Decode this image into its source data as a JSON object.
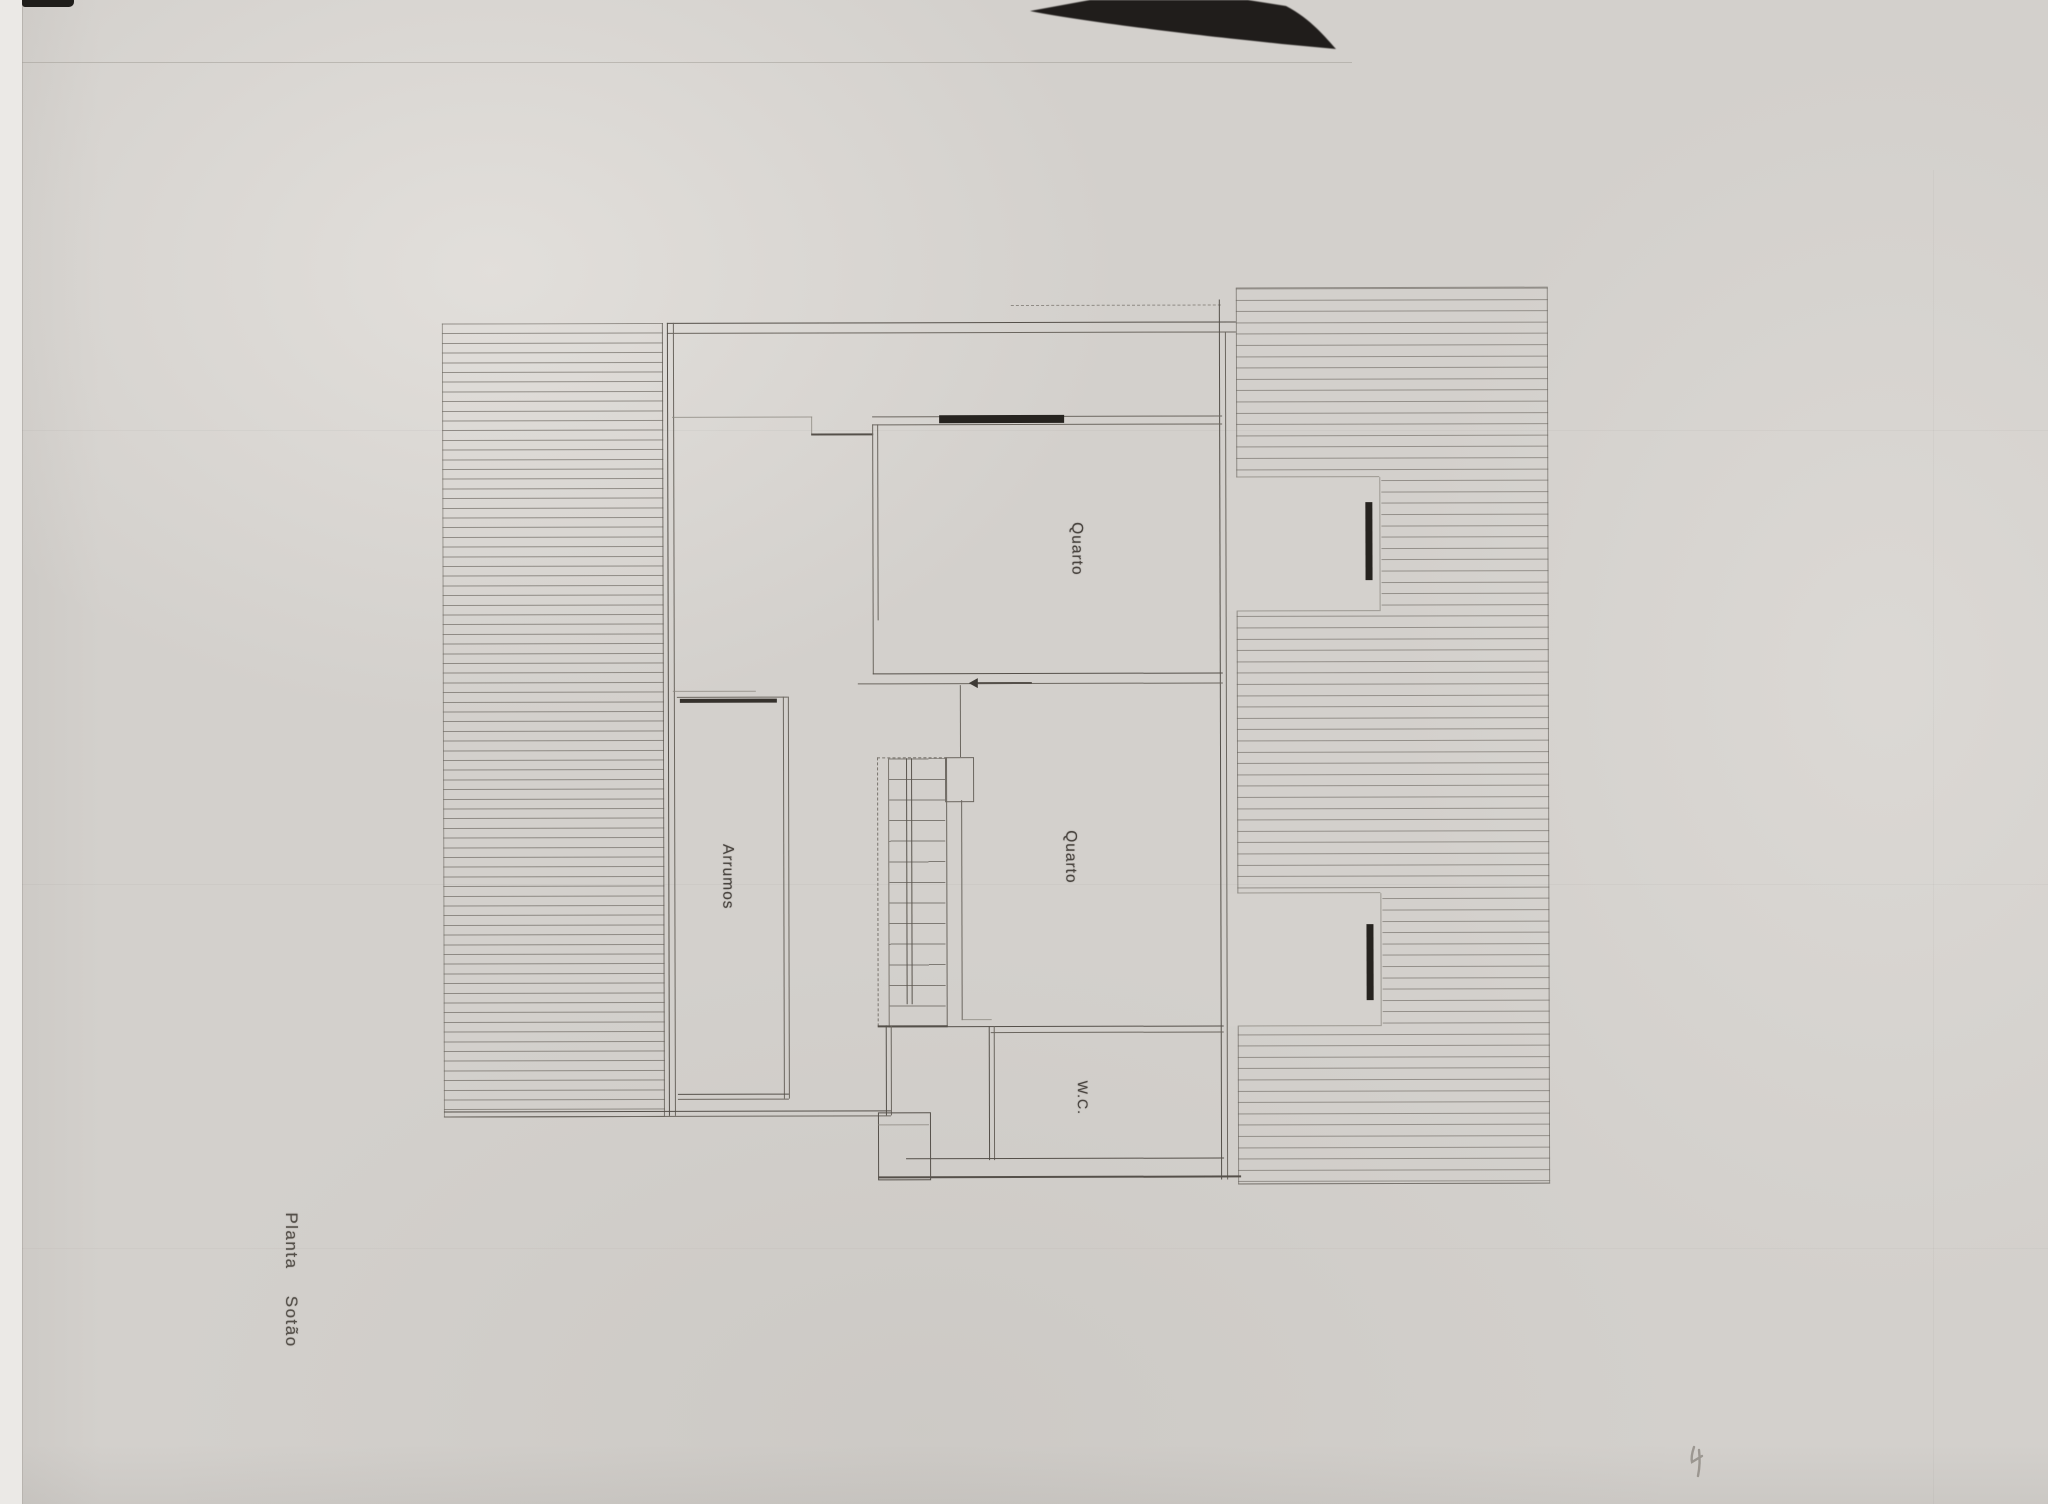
{
  "plan": {
    "caption": "Planta Sotão",
    "rooms": [
      {
        "name": "quarto-top",
        "label": "Quarto"
      },
      {
        "name": "quarto-middle",
        "label": "Quarto"
      },
      {
        "name": "arrumos",
        "label": "Arrumos"
      },
      {
        "name": "wc",
        "label": "W.C."
      }
    ]
  },
  "colors": {
    "paper": "#d3d0cc",
    "scanner_edge": "#ebe9e6",
    "ink_text": "#4a4540",
    "wall": "#5a554e",
    "hatch": "#64605a",
    "window_marker": "#26231f",
    "scan_artifact": "#201d1b"
  }
}
